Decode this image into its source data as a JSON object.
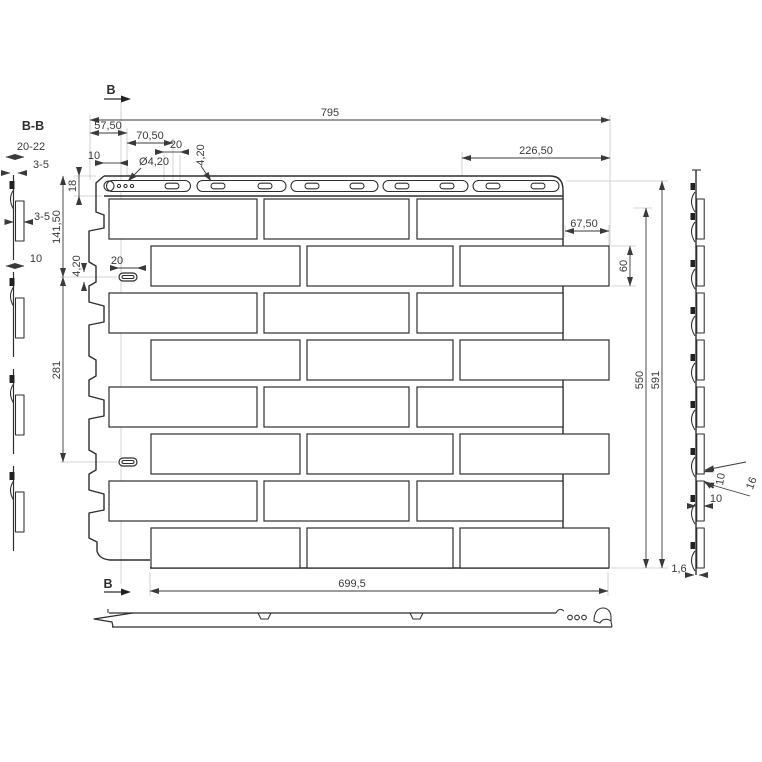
{
  "meta": {
    "background": "#ffffff",
    "line_color": "#2e2e2e",
    "dim_color": "#3a3a3a",
    "construction_color": "#c3c8cc"
  },
  "section_view": {
    "label": "B-B",
    "dims": {
      "width": "20-22",
      "thickness": "3-5",
      "relief": "3-5",
      "flange": "10"
    }
  },
  "front_view": {
    "cut_top": "B",
    "cut_bottom": "B",
    "dims": {
      "overall_width": "795",
      "left_offset": "57,50",
      "to_first_slot": "70,50",
      "slot_length_top": "20",
      "edge_to_hole": "10",
      "hole_diameter": "Ø4,20",
      "slot_width_top": "4,20",
      "right_span": "226,50",
      "strip_height": "18",
      "to_left_slot": "141,50",
      "left_slot_width": "4,20",
      "left_slot_length": "20",
      "between_slots": "281",
      "brick_offset": "67,50",
      "brick_height": "60",
      "body_height": "550",
      "overall_height": "591",
      "bottom_width": "699,5"
    }
  },
  "side_view": {
    "dims": {
      "joint_gap": "10",
      "step": "16",
      "depth": "10",
      "sheet_thickness": "1,6"
    }
  }
}
